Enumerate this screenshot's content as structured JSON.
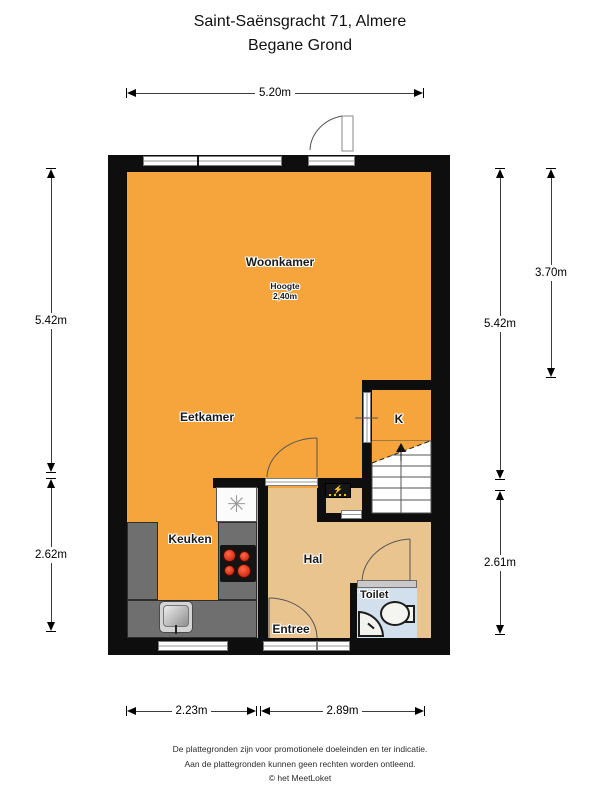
{
  "title": {
    "line1": "Saint-Saënsgracht 71, Almere",
    "line2": "Begane Grond"
  },
  "floor": {
    "rooms": {
      "woonkamer": "Woonkamer",
      "eetkamer": "Eetkamer",
      "keuken": "Keuken",
      "hal": "Hal",
      "entree": "Entree",
      "toilet": "Toilet",
      "kast": "K"
    },
    "ceiling_note": {
      "label": "Hoogte",
      "value": "2,40m"
    }
  },
  "dimensions": {
    "top": "5.20m",
    "left_upper": "5.42m",
    "left_lower": "2.62m",
    "right_outer": "3.70m",
    "right_inner_upper": "5.42m",
    "right_inner_lower": "2.61m",
    "bottom_left": "2.23m",
    "bottom_right": "2.89m"
  },
  "icons": {
    "ventilation_symbol": "✳",
    "panel_symbol": "⚡"
  },
  "colors": {
    "living_area_orange": "#F5A53C",
    "hallway_tan": "#EAC48F",
    "toilet_blue": "#D2DFEC",
    "wall_black": "#0E0E0E",
    "counter_gray": "#6F6F6F",
    "burner_red": "#D92A12",
    "panel_yellow": "#F2C21B"
  },
  "footer": {
    "line1": "De plattegronden zijn voor promotionele doeleinden en ter indicatie.",
    "line2": "Aan de plattegronden kunnen geen rechten worden ontleend.",
    "line3": "© het MeetLoket"
  }
}
